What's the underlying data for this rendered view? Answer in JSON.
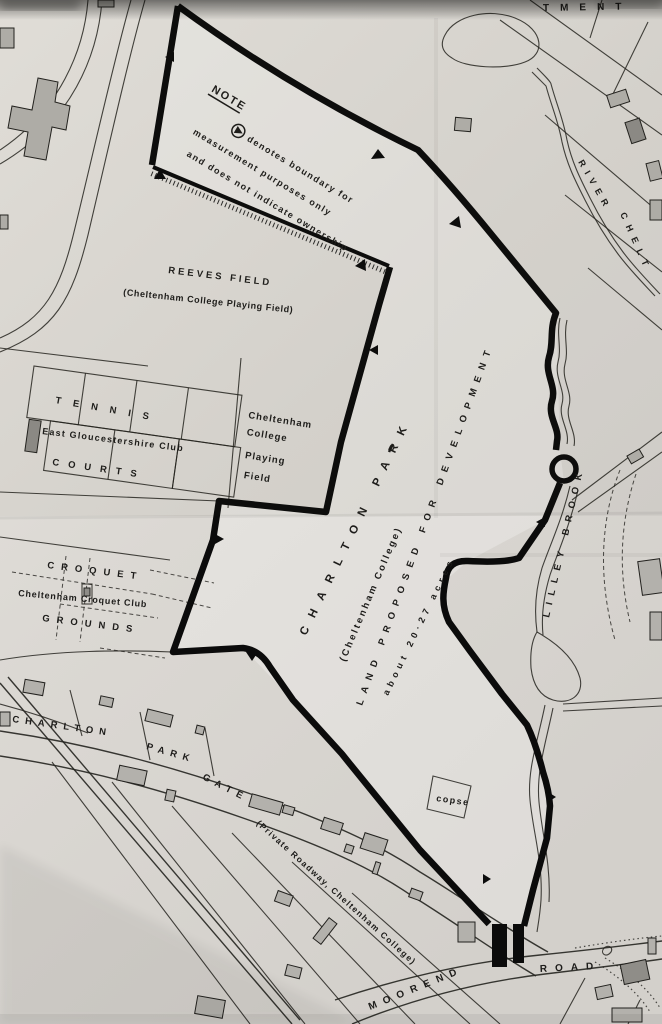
{
  "document": {
    "type": "scanned survey map",
    "subject": "Charlton Park, Cheltenham — land proposed for development"
  },
  "colors": {
    "paper": "#e0ddd8",
    "ink": "#1d1c1a",
    "boundary": "#0b0b0b",
    "building_fill": "#b3b1ac"
  },
  "icons": {
    "note_symbol": "circled-right-triangle",
    "boundary_marker": "solid-triangle-arrow"
  },
  "note": {
    "heading": "NOTE",
    "line1": "denotes boundary for",
    "line2": "measurement purposes only",
    "line3": "and does not indicate ownership"
  },
  "labels": {
    "top_partial": "TMENT",
    "reeves_field": "REEVES  FIELD",
    "reeves_field_sub": "(Cheltenham College Playing Field)",
    "tennis": "TENNIS",
    "east_gloucestershire_club": "East Gloucestershire Club",
    "courts": "COURTS",
    "college_field_lines": [
      "Cheltenham",
      "College",
      "Playing",
      "Field"
    ],
    "croquet": "CROQUET",
    "cheltenham_croquet_club": "Cheltenham Croquet Club",
    "grounds": "GROUNDS",
    "charlton_park": "CHARLTON PARK",
    "charlton_park_sub": "(Cheltenham College)",
    "land_proposed": "LAND PROPOSED FOR DEVELOPMENT",
    "acreage": "about 20·27 acres",
    "lilley_brook": "LILLEY BROOK",
    "river_chelt_1": "RIVER",
    "river_chelt_2": "CHELT",
    "charlton_park_gate_1": "CHARLTON",
    "charlton_park_gate_2": "PARK",
    "charlton_park_gate_3": "GATE",
    "private_roadway": "(Private Roadway, Cheltenham College)",
    "copse": "copse",
    "moorend": "MOOREND",
    "road": "ROAD"
  }
}
